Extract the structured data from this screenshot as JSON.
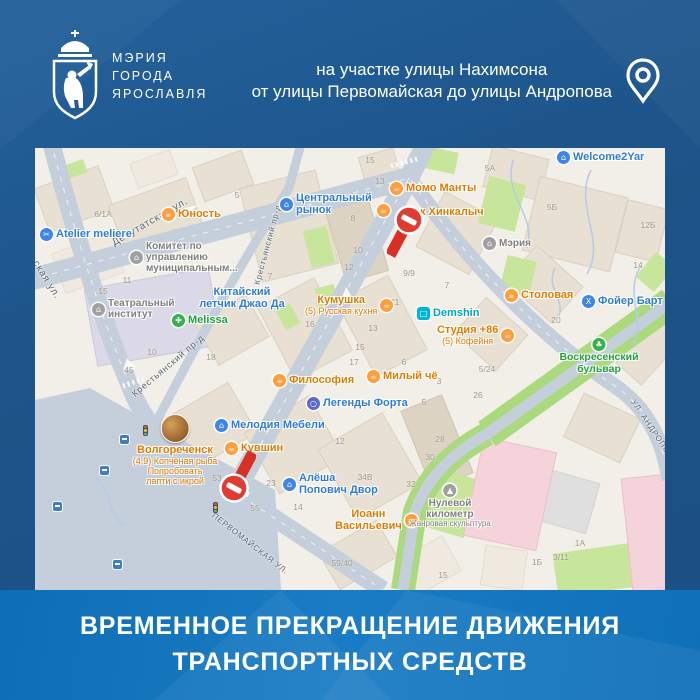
{
  "org": {
    "name_lines": [
      "МЭРИЯ",
      "ГОРОДА",
      "ЯРОСЛАВЛЯ"
    ]
  },
  "location": {
    "line1": "на участке улицы Нахимсона",
    "line2": "от улицы Первомайская до улицы Андропова"
  },
  "banner": {
    "line1": "ВРЕМЕННОЕ ПРЕКРАЩЕНИЕ ДВИЖЕНИЯ",
    "line2": "ТРАНСПОРТНЫХ СРЕДСТВ"
  },
  "colors": {
    "background_blue": "#1d5489",
    "banner_blue": "#1173bb",
    "closure_red": "#e03c31",
    "map_background": "#f2efe8",
    "road_gray": "#c5cedb",
    "poi_orange": "#e07c00",
    "poi_blue": "#2e7cd6",
    "poi_gray": "#7f7f7f",
    "poi_green": "#1fa33c",
    "poi_teal": "#00a3c4"
  },
  "map": {
    "street_labels": [
      {
        "t": "Депутатская ул.",
        "x": 78,
        "y": 90,
        "r": -30,
        "s": 10
      },
      {
        "t": "Крестьянский пр-д",
        "x": 222,
        "y": 132,
        "r": -75,
        "s": 8
      },
      {
        "t": "Крестьянский пр-д",
        "x": 98,
        "y": 242,
        "r": -40,
        "s": 9
      },
      {
        "t": "ская ул.",
        "x": 0,
        "y": 108,
        "r": 58,
        "s": 10
      },
      {
        "t": "ПЕРВОМАЙСКАЯ УЛ.",
        "x": 178,
        "y": 362,
        "r": 38,
        "s": 8
      },
      {
        "t": "УЛ. АНДРОПОВА",
        "x": 598,
        "y": 248,
        "r": 56,
        "s": 8
      }
    ],
    "poi": [
      {
        "x": 5,
        "y": 80,
        "cat": "blue",
        "glyph": "✂",
        "layout": "row",
        "lines": [
          {
            "t": "Atelier meliere",
            "s": 11
          }
        ]
      },
      {
        "x": 127,
        "y": 60,
        "cat": "orange",
        "glyph": "☕",
        "layout": "row",
        "lines": [
          {
            "t": "Юность",
            "s": 11
          }
        ]
      },
      {
        "x": 245,
        "y": 44,
        "cat": "blue",
        "glyph": "⌂",
        "layout": "row",
        "lines": [
          {
            "t": "Центральный",
            "s": 11
          },
          {
            "t": "рынок",
            "s": 11
          }
        ]
      },
      {
        "x": 355,
        "y": 34,
        "cat": "orange",
        "glyph": "☕",
        "layout": "row",
        "lines": [
          {
            "t": "Момо Манты",
            "s": 11
          }
        ]
      },
      {
        "x": 342,
        "y": 56,
        "cat": "orange",
        "glyph": "☕",
        "layout": "row",
        "lines": []
      },
      {
        "x": 385,
        "y": 58,
        "cat": "orange",
        "glyph": "",
        "layout": "row",
        "lines": [
          {
            "t": "к Хинкалыч",
            "s": 11
          }
        ]
      },
      {
        "x": 522,
        "y": 3,
        "cat": "blue",
        "glyph": "⌂",
        "layout": "row",
        "lines": [
          {
            "t": "Welcome2Yar",
            "s": 11
          }
        ]
      },
      {
        "x": 448,
        "y": 89,
        "cat": "gray",
        "glyph": "⌂",
        "layout": "row",
        "lines": [
          {
            "t": "Мэрия",
            "s": 10
          }
        ]
      },
      {
        "x": 95,
        "y": 93,
        "cat": "gray",
        "glyph": "⌂",
        "layout": "row",
        "lines": [
          {
            "t": "Комитет по",
            "s": 10
          },
          {
            "t": "управлению",
            "s": 10
          },
          {
            "t": "муниципальным...",
            "s": 10
          }
        ]
      },
      {
        "x": 207,
        "y": 138,
        "cat": "blue",
        "glyph": "",
        "layout": "col",
        "lines": [
          {
            "t": "Китайский",
            "s": 11
          },
          {
            "t": "летчик Джао Да",
            "s": 11
          }
        ]
      },
      {
        "x": 57,
        "y": 150,
        "cat": "gray",
        "glyph": "⌂",
        "layout": "row",
        "lines": [
          {
            "t": "Театральный",
            "s": 10
          },
          {
            "t": "институт",
            "s": 10
          }
        ]
      },
      {
        "x": 137,
        "y": 166,
        "cat": "green",
        "glyph": "✚",
        "layout": "row",
        "lines": [
          {
            "t": "Melissa",
            "s": 11
          }
        ]
      },
      {
        "x": 270,
        "y": 146,
        "cat": "orange",
        "glyph": "☕",
        "layout": "rowr",
        "lines": [
          {
            "t": "Кумушка",
            "s": 11
          },
          {
            "t": "(5) Русская кухня",
            "s": 9
          }
        ]
      },
      {
        "x": 382,
        "y": 159,
        "cat": "teal",
        "glyph": "□",
        "layout": "row",
        "lines": [
          {
            "t": "Demshin",
            "s": 11
          }
        ]
      },
      {
        "x": 402,
        "y": 176,
        "cat": "orange",
        "glyph": "☕",
        "layout": "rowr",
        "lines": [
          {
            "t": "Студия +86",
            "s": 11
          },
          {
            "t": "(5) Кофейня",
            "s": 9
          }
        ]
      },
      {
        "x": 470,
        "y": 141,
        "cat": "orange",
        "glyph": "☕",
        "layout": "row",
        "lines": [
          {
            "t": "Столовая",
            "s": 11
          }
        ]
      },
      {
        "x": 547,
        "y": 147,
        "cat": "blue",
        "glyph": "X",
        "layout": "row",
        "lines": [
          {
            "t": "Фойер Барт",
            "s": 11
          }
        ]
      },
      {
        "x": 238,
        "y": 226,
        "cat": "orange",
        "glyph": "☕",
        "layout": "row",
        "lines": [
          {
            "t": "Философия",
            "s": 11
          }
        ]
      },
      {
        "x": 332,
        "y": 222,
        "cat": "orange",
        "glyph": "☕",
        "layout": "row",
        "lines": [
          {
            "t": "Милый чё",
            "s": 11
          }
        ]
      },
      {
        "x": 272,
        "y": 249,
        "cat": "indigo",
        "glyph": "○",
        "layout": "row",
        "lines": [
          {
            "t": "Легенды Форта",
            "s": 11
          }
        ]
      },
      {
        "x": 180,
        "y": 271,
        "cat": "blue",
        "glyph": "⌂",
        "layout": "row",
        "lines": [
          {
            "t": "Мелодия Мебели",
            "s": 11
          }
        ]
      },
      {
        "x": 190,
        "y": 294,
        "cat": "orange",
        "glyph": "☕",
        "layout": "row",
        "lines": [
          {
            "t": "Кувшин",
            "s": 11
          }
        ]
      },
      {
        "x": 248,
        "y": 324,
        "cat": "blue",
        "glyph": "⌂",
        "layout": "row",
        "lines": [
          {
            "t": "Алёша",
            "s": 11
          },
          {
            "t": "Попович Двор",
            "s": 11
          }
        ]
      },
      {
        "x": 140,
        "y": 266,
        "cat": "orange",
        "glyph": "",
        "layout": "col",
        "photo": true,
        "lines": [
          {
            "t": "Волгореченск",
            "s": 11
          },
          {
            "t": "(4,9) Копчёная рыба",
            "s": 9
          },
          {
            "t": "Попробовать",
            "s": 9
          },
          {
            "t": "лапти с икрой",
            "s": 9
          }
        ]
      },
      {
        "x": 300,
        "y": 360,
        "cat": "orange",
        "glyph": "☕",
        "layout": "rowr",
        "lines": [
          {
            "t": "Иоанн",
            "s": 11
          },
          {
            "t": "Васильевич",
            "s": 11
          }
        ]
      },
      {
        "x": 415,
        "y": 336,
        "cat": "gray",
        "glyph": "▲",
        "layout": "col",
        "lines": [
          {
            "t": "Нулевой",
            "s": 10
          },
          {
            "t": "километр",
            "s": 10
          },
          {
            "t": "Жанровая скульптура",
            "s": 8
          }
        ]
      },
      {
        "x": 564,
        "y": 190,
        "cat": "green",
        "glyph": "♣",
        "layout": "col",
        "lines": [
          {
            "t": "Воскресенский",
            "s": 10.5
          },
          {
            "t": "бульвар",
            "s": 10.5
          }
        ]
      }
    ],
    "numbers": [
      [
        68,
        66,
        "6/1А"
      ],
      [
        202,
        47,
        "5"
      ],
      [
        92,
        132,
        "11"
      ],
      [
        68,
        143,
        "15"
      ],
      [
        335,
        12,
        "15"
      ],
      [
        345,
        33,
        "13"
      ],
      [
        318,
        70,
        "8"
      ],
      [
        323,
        102,
        "10"
      ],
      [
        314,
        119,
        "12"
      ],
      [
        374,
        125,
        "9/9"
      ],
      [
        412,
        137,
        "7"
      ],
      [
        235,
        128,
        "7"
      ],
      [
        455,
        20,
        "5А"
      ],
      [
        517,
        59,
        "5Б"
      ],
      [
        613,
        77,
        "12Б"
      ],
      [
        603,
        117,
        "14"
      ],
      [
        117,
        204,
        "10"
      ],
      [
        94,
        222,
        "45"
      ],
      [
        176,
        209,
        "18"
      ],
      [
        275,
        176,
        "16"
      ],
      [
        338,
        180,
        "13"
      ],
      [
        325,
        199,
        "15"
      ],
      [
        319,
        214,
        "17"
      ],
      [
        360,
        154,
        "11"
      ],
      [
        369,
        214,
        "6"
      ],
      [
        404,
        233,
        "3"
      ],
      [
        389,
        254,
        "5"
      ],
      [
        443,
        247,
        "26"
      ],
      [
        452,
        221,
        "5/24"
      ],
      [
        521,
        172,
        "20"
      ],
      [
        405,
        291,
        "28"
      ],
      [
        395,
        309,
        "30"
      ],
      [
        376,
        336,
        "32"
      ],
      [
        330,
        329,
        "34В"
      ],
      [
        236,
        335,
        "23"
      ],
      [
        263,
        359,
        "14"
      ],
      [
        305,
        293,
        "12"
      ],
      [
        182,
        330,
        "53"
      ],
      [
        220,
        360,
        "55"
      ],
      [
        307,
        415,
        "59/40"
      ],
      [
        408,
        427,
        "15"
      ],
      [
        526,
        409,
        "3/11"
      ],
      [
        545,
        395,
        "1А"
      ],
      [
        502,
        414,
        "1Б"
      ]
    ],
    "signs": [
      {
        "x": 374,
        "y": 72,
        "dir": "down"
      },
      {
        "x": 199,
        "y": 340,
        "dir": "up"
      }
    ],
    "bus_stops": [
      [
        65,
        318
      ],
      [
        18,
        354
      ],
      [
        78,
        412
      ],
      [
        85,
        287
      ]
    ],
    "traffic_lights": [
      [
        108,
        277
      ],
      [
        178,
        354
      ]
    ],
    "layout": {
      "blocks": [
        [
          5,
          28,
          68,
          46,
          -20,
          0
        ],
        [
          80,
          42,
          82,
          52,
          -20,
          0
        ],
        [
          162,
          10,
          52,
          36,
          -20,
          0
        ],
        [
          22,
          94,
          62,
          42,
          -20,
          2
        ],
        [
          215,
          30,
          78,
          96,
          -14,
          0
        ],
        [
          300,
          54,
          44,
          76,
          -16,
          1
        ],
        [
          328,
          4,
          36,
          40,
          -16,
          0
        ],
        [
          392,
          54,
          60,
          62,
          28,
          0
        ],
        [
          452,
          4,
          58,
          42,
          14,
          0
        ],
        [
          495,
          38,
          90,
          76,
          14,
          0
        ],
        [
          586,
          56,
          42,
          54,
          14,
          0
        ],
        [
          55,
          130,
          126,
          78,
          -10,
          3
        ],
        [
          168,
          158,
          58,
          48,
          -30,
          0
        ],
        [
          238,
          140,
          64,
          82,
          -28,
          0
        ],
        [
          318,
          136,
          58,
          84,
          -28,
          0
        ],
        [
          428,
          162,
          56,
          48,
          42,
          0
        ],
        [
          478,
          112,
          62,
          48,
          42,
          0
        ],
        [
          142,
          248,
          70,
          58,
          -30,
          0
        ],
        [
          222,
          262,
          74,
          70,
          -30,
          0
        ],
        [
          298,
          278,
          74,
          80,
          -30,
          0
        ],
        [
          380,
          252,
          44,
          84,
          -22,
          1
        ],
        [
          536,
          256,
          62,
          48,
          25,
          0
        ],
        [
          495,
          326,
          64,
          52,
          16,
          5
        ],
        [
          290,
          386,
          66,
          42,
          -30,
          0
        ],
        [
          598,
          170,
          34,
          64,
          42,
          0
        ],
        [
          368,
          398,
          52,
          40,
          -30,
          2
        ],
        [
          98,
          8,
          42,
          26,
          -20,
          2
        ],
        [
          448,
          400,
          42,
          40,
          8,
          2
        ]
      ],
      "pinks": [
        [
          438,
          296,
          74,
          100,
          12
        ],
        [
          592,
          328,
          50,
          114,
          -6
        ]
      ],
      "greens": [
        [
          378,
          0,
          44,
          22,
          12
        ],
        [
          272,
          80,
          24,
          38,
          -14
        ],
        [
          282,
          138,
          20,
          24,
          -14
        ],
        [
          448,
          32,
          38,
          48,
          14
        ],
        [
          468,
          110,
          30,
          36,
          14
        ],
        [
          386,
          324,
          52,
          60,
          16
        ],
        [
          520,
          398,
          110,
          44,
          -8
        ],
        [
          75,
          408,
          64,
          26,
          -6
        ],
        [
          0,
          296,
          28,
          16,
          0
        ],
        [
          25,
          15,
          26,
          14,
          -20
        ],
        [
          245,
          158,
          16,
          22,
          -28
        ],
        [
          608,
          108,
          24,
          32,
          40
        ]
      ]
    }
  }
}
